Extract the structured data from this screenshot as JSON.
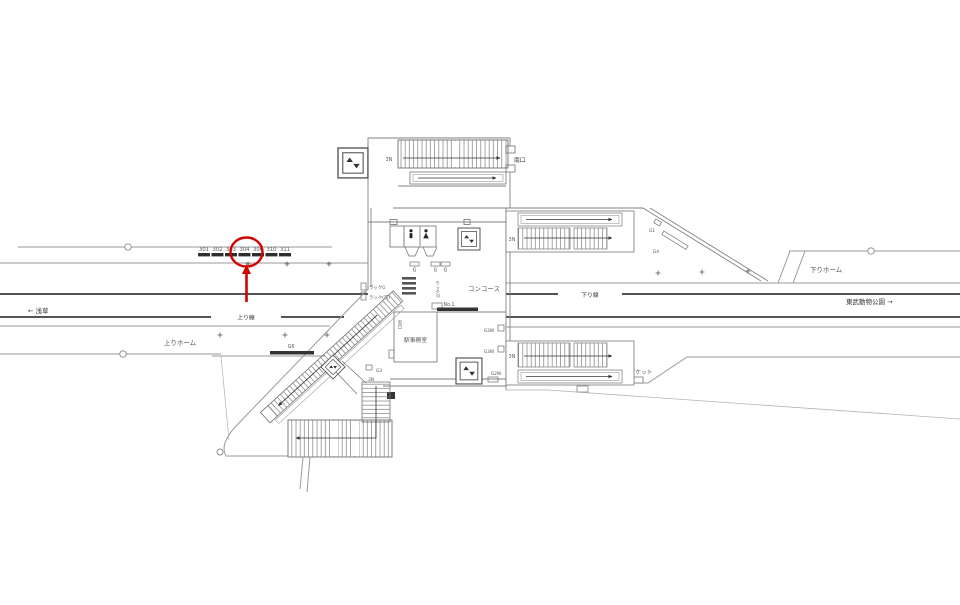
{
  "map": {
    "billboard_numbers": [
      "301",
      "302",
      "303",
      "304",
      "306",
      "310",
      "311"
    ],
    "labels": {
      "south_exit": "南口",
      "down_platform": "下りホーム",
      "up_platform": "上りホーム",
      "down_line": "下り線",
      "up_line": "上り線",
      "toward_asakusa": "← 浅草",
      "toward_tobu_zoo": "東武動物公園 →",
      "concourse": "コンコース",
      "station_office": "駅事務室",
      "ticket_window": "窓口",
      "pocket": "ポケット",
      "rack_g": "ラックG",
      "rack_movable": "ラック(可)",
      "rack_g_2": "ラックG",
      "no_1": "No.1",
      "g6": "G6",
      "g3": "G3",
      "g1": "G1",
      "g4": "G4",
      "g3w_upper": "G3W",
      "g3w_lower": "G3W",
      "g2w": "G2W",
      "g_left": "G",
      "g_mid": "G",
      "g_right": "G",
      "stairs_north": "3N",
      "stairs_east_upper": "3N",
      "stairs_east_lower": "3N",
      "stairs_south": "3N"
    },
    "colors": {
      "highlight_red": "#d40000",
      "track_line": "#1b1b1b",
      "wall_gray": "#808080"
    }
  }
}
